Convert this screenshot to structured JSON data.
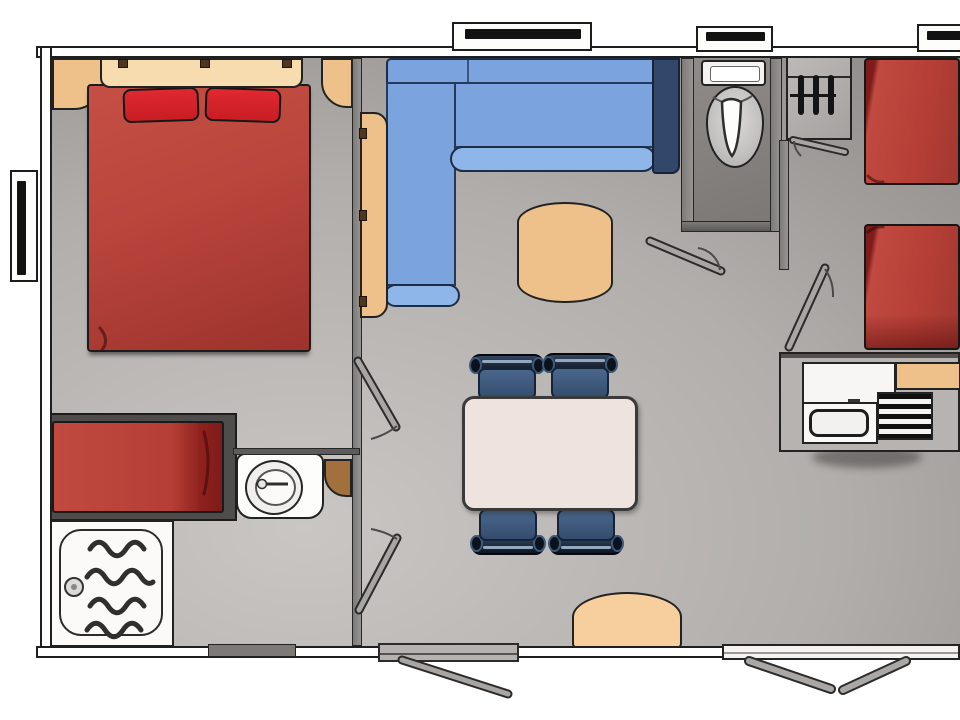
{
  "meta": {
    "kind": "floor-plan-diagram",
    "canvas_px": {
      "width": 960,
      "height": 720
    },
    "visible_text": []
  },
  "palette": {
    "floor_light": "#c9c6c3",
    "floor_mid": "#b1aeab",
    "floor_dark": "#8e8b88",
    "wall_fill": "#ffffff",
    "outline": "#1f1f1f",
    "partition": "#8a8886",
    "red": "#b9453c",
    "red_deep": "#9c332c",
    "pillow_red": "#c91d24",
    "red_fold": "#7e1b1b",
    "sofa_blue": "#7ba4df",
    "sofa_blue_light": "#8fb6e8",
    "sofa_navy": "#31486b",
    "tan": "#eec08a",
    "tan_light": "#f6dcae",
    "tan_deep": "#a1703d",
    "cream": "#efe3df",
    "chair_navy": "#0c1420",
    "chair_seat": "#3f5a7c",
    "chair_highlight": "#93a9c0",
    "gray_unit": "#b7b3b0",
    "door_gray": "#a8a5a2",
    "fixture_white": "#f9f8f7"
  },
  "rooms": [
    {
      "id": "master-bedroom",
      "furniture": [
        "double-bed",
        "pillow",
        "pillow",
        "headboard-shelf",
        "corner-shelf-left",
        "corner-shelf-right"
      ]
    },
    {
      "id": "shower-room",
      "furniture": [
        "single-bed",
        "washbasin",
        "corner-shelf",
        "shower-tray-with-drain"
      ]
    },
    {
      "id": "living-dining",
      "furniture": [
        "corner-sofa-blue",
        "folding-side-panel",
        "coffee-table",
        "dining-table",
        "dining-chair",
        "dining-chair",
        "dining-chair",
        "dining-chair",
        "bench"
      ]
    },
    {
      "id": "wc",
      "furniture": [
        "toilet-with-cistern"
      ]
    },
    {
      "id": "hallway",
      "furniture": [
        "wardrobe-with-hangers"
      ]
    },
    {
      "id": "twin-bedroom",
      "furniture": [
        "single-bed",
        "single-bed"
      ]
    },
    {
      "id": "kitchenette",
      "furniture": [
        "fridge",
        "sink",
        "drainer",
        "worktop"
      ]
    }
  ],
  "openings": {
    "windows": [
      "left-wall-window",
      "top-wall-window-over-sofa",
      "top-wall-window-over-wc",
      "top-wall-window-right"
    ],
    "interior_doors": [
      "master-bedroom-door",
      "shower-room-door",
      "wc-door",
      "wardrobe-door",
      "twin-bedroom-door"
    ],
    "entrance_door": 1,
    "sliding_bay": 1,
    "hangers_in_wardrobe": 3,
    "dining_chairs": 4
  }
}
